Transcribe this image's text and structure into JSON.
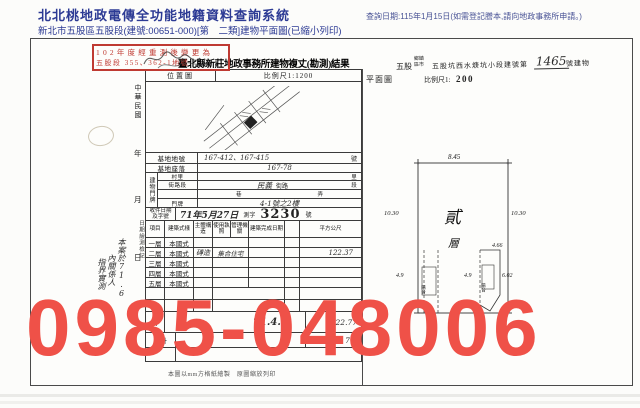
{
  "header": {
    "system_title": "北北桃地政電傳全功能地籍資料查詢系統",
    "doc_info": "新北市五股區五股段(建號:00651-000)[第　二類]建物平面圖(已縮小列印)",
    "query_date": "查詢日期:115年1月15日(如需登記謄本,請向地政事務所申請。)"
  },
  "watermark": {
    "phone": "0985-048006",
    "color": "#ef5148"
  },
  "stamp": {
    "line1": "102年度經重測後變更為",
    "line2": "五股段 355、362-1地號",
    "color": "#bf3a32"
  },
  "form": {
    "title": "臺北縣新莊地政事務所建物複丈(勘測)結果",
    "location_map": {
      "label": "位置圖",
      "scale": "比例尺1:1200"
    },
    "margin": {
      "era": "中華民國",
      "year": "年",
      "month": "月",
      "day": "日",
      "side_label": "日期繪測檢記",
      "note1": "本案於71.6",
      "note2": "內關係人",
      "note3": "指界實測"
    },
    "fields": {
      "site_no_label": "基地地號",
      "site_no_value": "167-412、167-415",
      "site_no_unit": "號",
      "site_loc_label": "基地座落",
      "site_loc_value": "167-78",
      "building_label": "建物門牌",
      "village_label": "村里",
      "village_unit": "里",
      "street_label": "街路段",
      "street_value": "民義",
      "street_print": "街路",
      "street_unit": "段",
      "lane_label": "巷",
      "alley_label": "弄",
      "door_label": "門牌",
      "door_value": "4-1號之2樓",
      "receipt_label": "收件日期及字號",
      "receipt_date": "71年5月27日",
      "receipt_word": "測字",
      "receipt_no": "3230",
      "receipt_unit": "號"
    },
    "table": {
      "headers": {
        "h1": "項目",
        "h2": "建築式樣",
        "h3": "主體構造",
        "h4": "使用執照",
        "h5": "管理機關",
        "h6": "建築完成日期",
        "h7": "平方公尺"
      },
      "floors": [
        {
          "name": "一層",
          "style": "本國式",
          "structure": "",
          "use": "",
          "area": ""
        },
        {
          "name": "二層",
          "style": "本國式",
          "structure": "磚造",
          "use": "集合住宅",
          "area": "122.37"
        },
        {
          "name": "三層",
          "style": "本國式",
          "structure": "",
          "use": "",
          "area": ""
        },
        {
          "name": "四層",
          "style": "本國式",
          "structure": "",
          "use": "",
          "area": ""
        },
        {
          "name": "五層",
          "style": "本國式",
          "structure": "",
          "use": "",
          "area": ""
        }
      ],
      "total": {
        "name": "計",
        "date": "71.4.",
        "area": "122.77"
      },
      "sum": {
        "name": "合計",
        "area": "7.6"
      }
    },
    "footer_note": "本圖以mm方格紙繪製　原圖縮放列印",
    "plan": {
      "town": "五股",
      "unit_top": "鄉鎮",
      "unit_bottom": "區市",
      "section": "五股坑西水焿坑小段建號第",
      "number": "1465",
      "tail": "號建物",
      "label": "平面圖",
      "scale_label": "比例尺1:",
      "scale_value": "200",
      "floor1": "貳",
      "floor2": "層",
      "dims": {
        "top": "8.45",
        "left": "10.30",
        "right": "10.30",
        "d1": "4.9",
        "d2": "4.9",
        "d3": "4.66",
        "d4": "6.02",
        "balcony": "陽台"
      }
    }
  }
}
